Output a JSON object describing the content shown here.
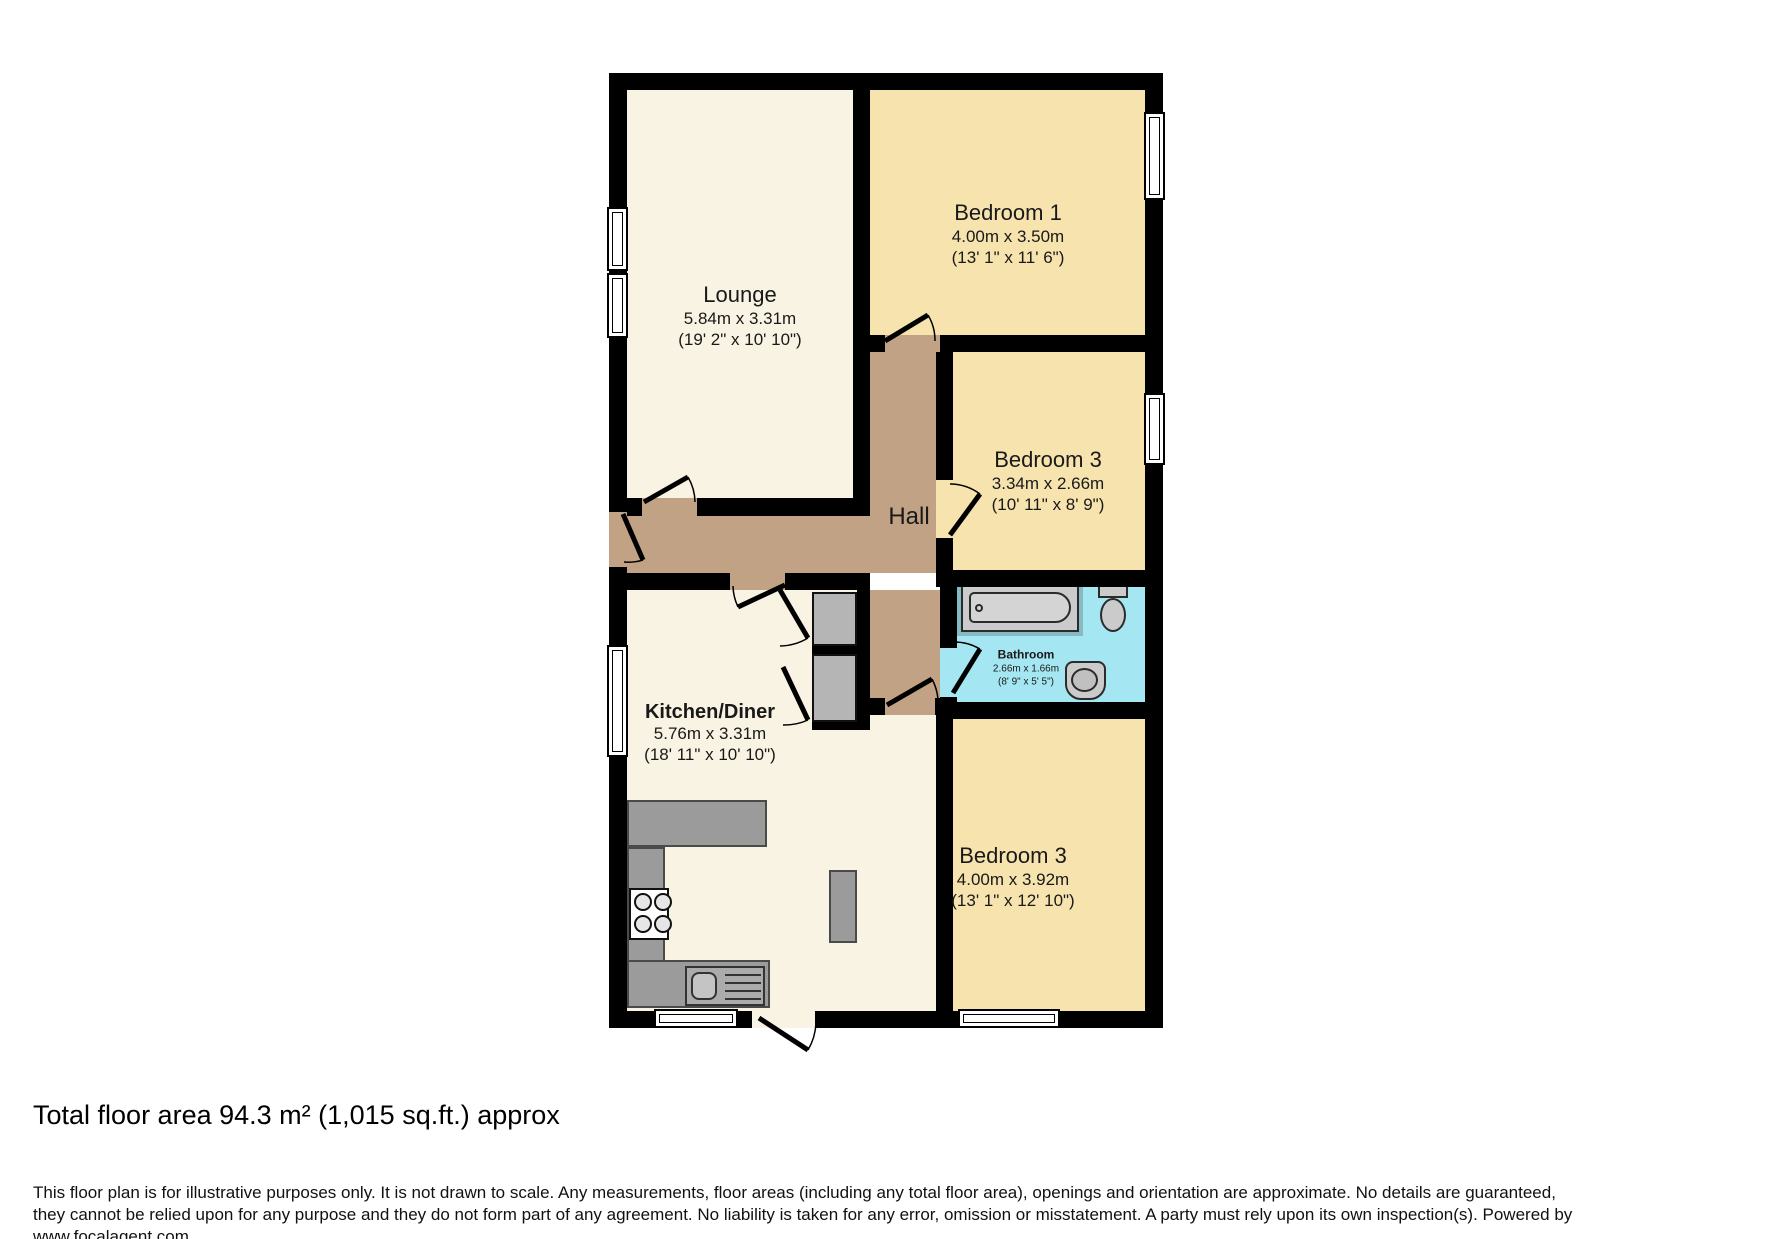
{
  "floorplan": {
    "rooms": {
      "lounge": {
        "name": "Lounge",
        "metric": "5.84m x 3.31m",
        "imperial": "(19' 2\" x 10' 10\")"
      },
      "bedroom1": {
        "name": "Bedroom 1",
        "metric": "4.00m x 3.50m",
        "imperial": "(13' 1\" x 11' 6\")"
      },
      "bedroom3_middle": {
        "name": "Bedroom 3",
        "metric": "3.34m x 2.66m",
        "imperial": "(10' 11\" x 8' 9\")"
      },
      "bathroom": {
        "name": "Bathroom",
        "metric": "2.66m x 1.66m",
        "imperial": "(8' 9\" x 5' 5\")"
      },
      "kitchen_diner": {
        "name": "Kitchen/Diner",
        "metric": "5.76m x 3.31m",
        "imperial": "(18' 11\" x 10' 10\")"
      },
      "bedroom3_bottom": {
        "name": "Bedroom 3",
        "metric": "4.00m x 3.92m",
        "imperial": "(13' 1\" x 12' 10\")"
      },
      "hall": {
        "name": "Hall"
      }
    },
    "colors": {
      "wall": "#000000",
      "lounge_kitchen_floor": "#F8F3E2",
      "bedroom_floor": "#F6E3AE",
      "hall_floor": "#C2A284",
      "bathroom_floor": "#A5E6F3",
      "fixture_gray": "#9B9B9B"
    }
  },
  "footer": {
    "total_area": "Total floor area 94.3 m² (1,015 sq.ft.) approx",
    "disclaimer": "This floor plan is for illustrative purposes only. It is not drawn to scale. Any measurements, floor areas (including any total floor area), openings and orientation are approximate. No details are guaranteed,\nthey cannot be relied upon for any purpose and they do not form part of any agreement. No liability is taken for any error, omission or misstatement. A party must rely upon its own inspection(s). Powered by\nwww.focalagent.com"
  }
}
